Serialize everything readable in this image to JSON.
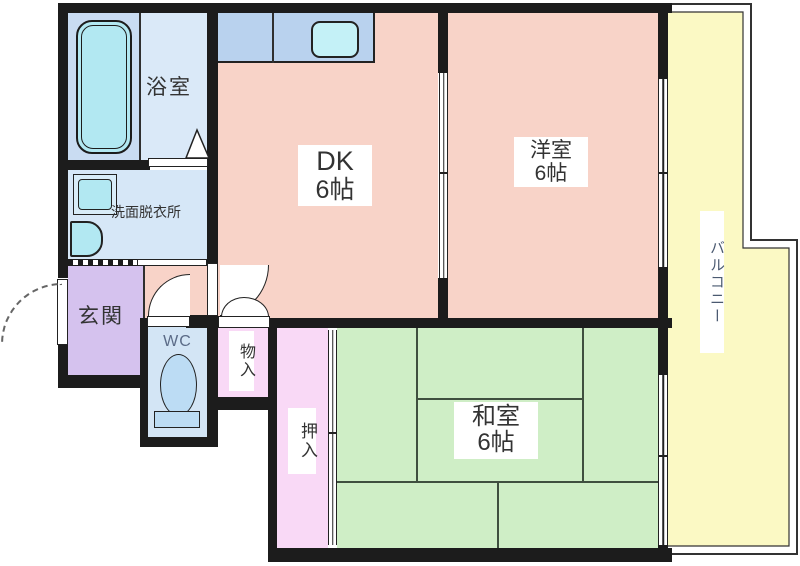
{
  "floorplan": {
    "title": "apartment-floorplan",
    "rooms": {
      "bathroom": {
        "label": "浴室"
      },
      "washroom": {
        "label": "洗面脱衣所"
      },
      "entrance": {
        "label": "玄関"
      },
      "toilet": {
        "label": "WC"
      },
      "storage": {
        "label": "物入"
      },
      "closet": {
        "label": "押入"
      },
      "dk": {
        "label": "DK",
        "size": "6帖"
      },
      "western_room": {
        "label": "洋室",
        "size": "6帖"
      },
      "japanese_room": {
        "label": "和室",
        "size": "6帖"
      },
      "balcony": {
        "label": "バルコニー"
      }
    },
    "colors": {
      "wall": "#1c1c1c",
      "outline": "#222222",
      "room_salmon": "#f8d3c8",
      "bath_zone": "#c9dcf2",
      "bath_room": "#dae9f8",
      "washroom": "#d6e7f7",
      "entrance": "#d5c2ee",
      "wc_room": "#d3e5f5",
      "closet_pink": "#f9d9f6",
      "tatami_green": "#cfeec6",
      "tatami_line": "#3f4f3f",
      "balcony": "#fbf9c4",
      "fixture_cyan": "#b2e8f2",
      "counter_blue": "#b9d2ee",
      "sink_cyan": "#c4f1f7",
      "toilet_blue": "#bcdcf4",
      "label_text": "#333333",
      "wc_text": "#5b6b87",
      "balcony_text": "#4a5970"
    }
  }
}
